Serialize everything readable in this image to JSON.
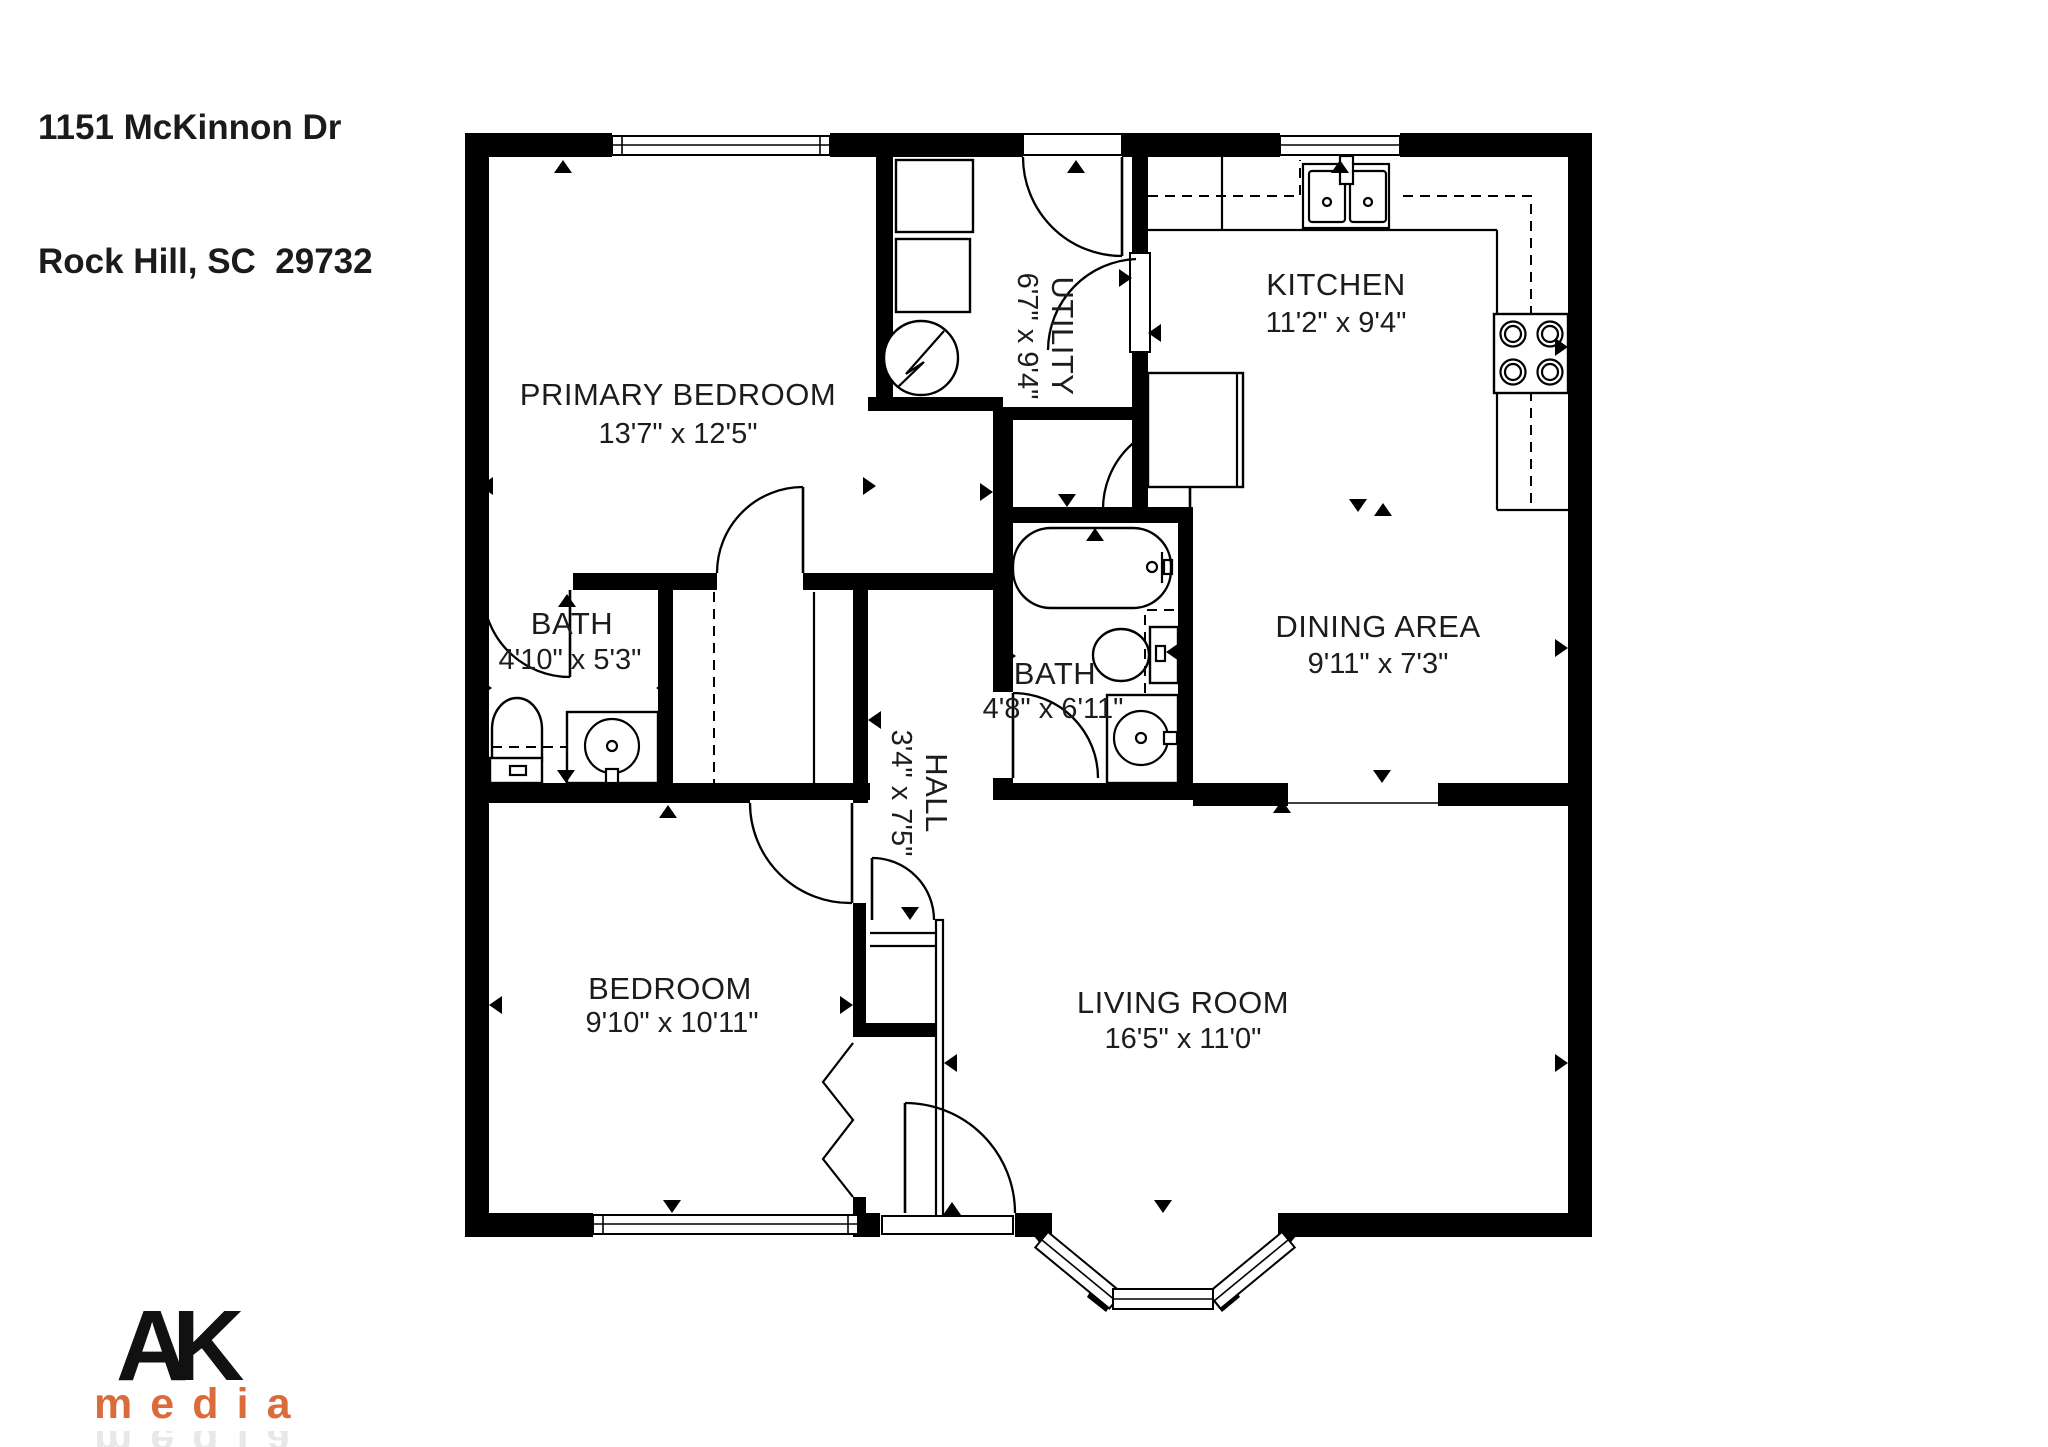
{
  "address": {
    "line1": "1151 McKinnon Dr",
    "line2": "Rock Hill, SC  29732"
  },
  "floor_plan": {
    "rooms": [
      {
        "id": "primary-bedroom",
        "name": "PRIMARY BEDROOM",
        "dimensions": "13'7\" x 12'5\""
      },
      {
        "id": "utility",
        "name": "UTILITY",
        "dimensions": "6'7\" x 9'4\""
      },
      {
        "id": "kitchen",
        "name": "KITCHEN",
        "dimensions": "11'2\" x 9'4\""
      },
      {
        "id": "bath-1",
        "name": "BATH",
        "dimensions": "4'10\" x 5'3\""
      },
      {
        "id": "bath-2",
        "name": "BATH",
        "dimensions": "4'8\" x 6'11\""
      },
      {
        "id": "hall",
        "name": "HALL",
        "dimensions": "3'4\" x 7'5\""
      },
      {
        "id": "dining-area",
        "name": "DINING AREA",
        "dimensions": "9'11\" x 7'3\""
      },
      {
        "id": "bedroom",
        "name": "BEDROOM",
        "dimensions": "9'10\" x 10'11\""
      },
      {
        "id": "living-room",
        "name": "LIVING ROOM",
        "dimensions": "16'5\" x 11'0\""
      }
    ]
  },
  "logo": {
    "line1": "AK",
    "line2": "media",
    "accent_color": "#DC6B3C",
    "text_color": "#111111"
  },
  "colors": {
    "walls": "#000000",
    "background": "#ffffff",
    "text": "#1c1c1c"
  }
}
